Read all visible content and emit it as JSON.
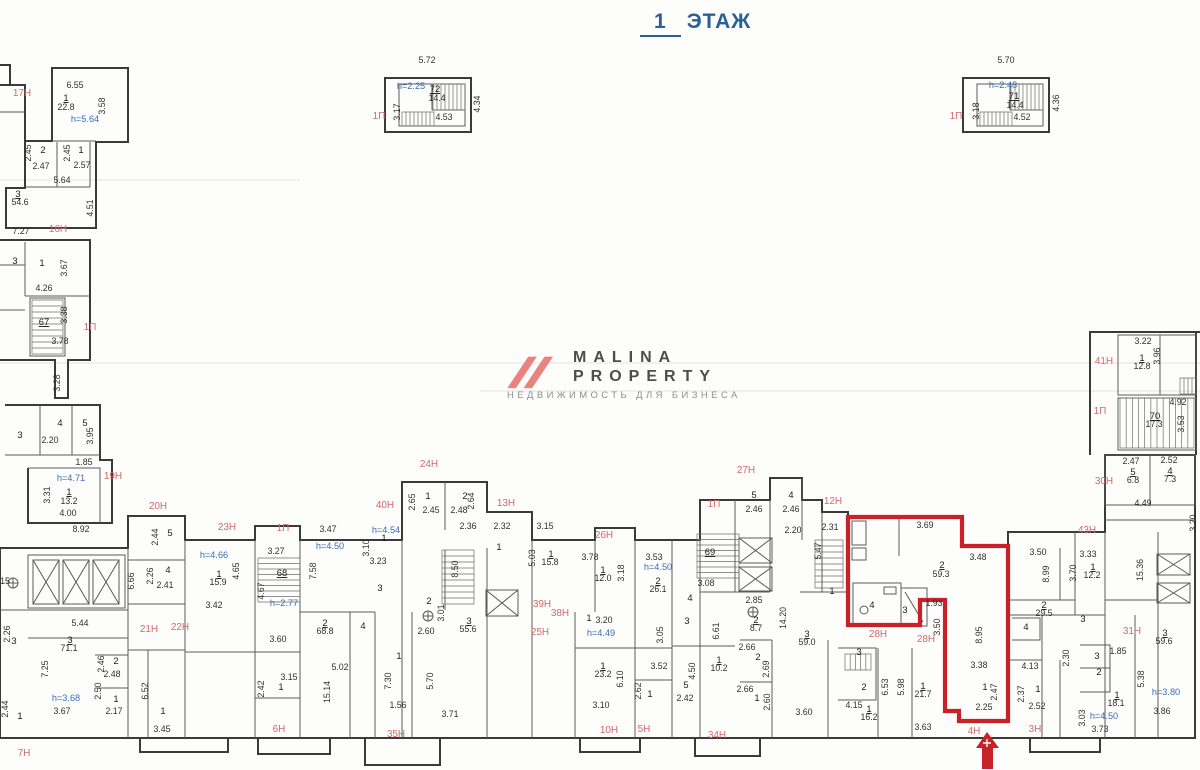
{
  "title": {
    "floor_number": "1",
    "floor_word": "ЭТАЖ"
  },
  "logo": {
    "line1": "MALINA",
    "line2": "PROPERTY",
    "tagline": "НЕДВИЖИМОСТЬ ДЛЯ БИЗНЕСА",
    "accent": "#e8837d",
    "text_color": "#4d4d4d"
  },
  "colors": {
    "title_blue": "#2a5f97",
    "dimension": "#2f2f2f",
    "unit_label_red": "#d4686d",
    "height_blue": "#3a6db4",
    "highlight_red": "#c82127",
    "wall": "#3a3a3a"
  },
  "highlight_unit": {
    "label": "4Н",
    "room_number": "2",
    "area_sqm": "59.3"
  },
  "labels": [
    [
      "5.72",
      427,
      63,
      "d",
      0
    ],
    [
      "h=2.25",
      411,
      89,
      "b",
      0
    ],
    [
      "72",
      435,
      92,
      "u",
      0
    ],
    [
      "14.4",
      437,
      101,
      "d",
      0
    ],
    [
      "3.17",
      400,
      112,
      "d",
      1
    ],
    [
      "4.34",
      480,
      104,
      "d",
      1
    ],
    [
      "4.53",
      444,
      120,
      "d",
      0
    ],
    [
      "1П",
      379,
      119,
      "r",
      0
    ],
    [
      "5.70",
      1006,
      63,
      "d",
      0
    ],
    [
      "h=2.48",
      1003,
      88,
      "b",
      0
    ],
    [
      "71",
      1014,
      99,
      "u",
      0
    ],
    [
      "14.4",
      1015,
      108,
      "d",
      0
    ],
    [
      "3.18",
      979,
      111,
      "d",
      1
    ],
    [
      "4.36",
      1059,
      103,
      "d",
      1
    ],
    [
      "4.52",
      1022,
      120,
      "d",
      0
    ],
    [
      "1П",
      956,
      119,
      "r",
      0
    ],
    [
      "17Н",
      22,
      96,
      "r",
      0
    ],
    [
      "6.55",
      75,
      88,
      "d",
      0
    ],
    [
      "1",
      66,
      101,
      "u",
      0
    ],
    [
      "22.8",
      66,
      110,
      "d",
      0
    ],
    [
      "3.58",
      105,
      106,
      "d",
      1
    ],
    [
      "h=5.64",
      85,
      122,
      "b",
      0
    ],
    [
      "2.45",
      31,
      153,
      "d",
      1
    ],
    [
      "2",
      43,
      153,
      "n",
      0
    ],
    [
      "2.47",
      41,
      169,
      "d",
      0
    ],
    [
      "2.45",
      70,
      153,
      "d",
      1
    ],
    [
      "1",
      81,
      153,
      "n",
      0
    ],
    [
      "2.57",
      82,
      168,
      "d",
      0
    ],
    [
      "5.64",
      62,
      183,
      "d",
      0
    ],
    [
      "3",
      18,
      197,
      "u",
      0
    ],
    [
      "54.6",
      20,
      205,
      "d",
      0
    ],
    [
      "4.51",
      93,
      208,
      "d",
      1
    ],
    [
      "7.27",
      21,
      234,
      "d",
      0
    ],
    [
      "16Н",
      58,
      232,
      "r",
      0
    ],
    [
      "3",
      15,
      264,
      "n",
      0
    ],
    [
      "1",
      42,
      266,
      "n",
      0
    ],
    [
      "3.67",
      67,
      268,
      "d",
      1
    ],
    [
      "4.26",
      44,
      291,
      "d",
      0
    ],
    [
      "67",
      44,
      325,
      "u",
      0
    ],
    [
      "3.38",
      67,
      315,
      "d",
      1
    ],
    [
      "1П",
      90,
      330,
      "r",
      0
    ],
    [
      "3.78",
      60,
      344,
      "d",
      0
    ],
    [
      "3.28",
      60,
      383,
      "d",
      1
    ],
    [
      "3",
      20,
      438,
      "n",
      0
    ],
    [
      "4",
      60,
      426,
      "n",
      0
    ],
    [
      "2.20",
      50,
      443,
      "d",
      0
    ],
    [
      "5",
      85,
      426,
      "n",
      0
    ],
    [
      "3.95",
      93,
      436,
      "d",
      1
    ],
    [
      "1.85",
      84,
      465,
      "d",
      0
    ],
    [
      "h=4.71",
      71,
      481,
      "b",
      0
    ],
    [
      "19Н",
      113,
      479,
      "r",
      0
    ],
    [
      "1",
      69,
      495,
      "u",
      0
    ],
    [
      "13.2",
      69,
      504,
      "d",
      0
    ],
    [
      "3.31",
      50,
      495,
      "d",
      1
    ],
    [
      "4.00",
      68,
      516,
      "d",
      0
    ],
    [
      "8.92",
      81,
      532,
      "d",
      0
    ],
    [
      "15",
      5,
      584,
      "d",
      0
    ],
    [
      "2.26",
      10,
      634,
      "d",
      1
    ],
    [
      "3",
      14,
      644,
      "n",
      0
    ],
    [
      "5.44",
      80,
      626,
      "d",
      0
    ],
    [
      "6.66",
      134,
      581,
      "d",
      1
    ],
    [
      "2.26",
      153,
      576,
      "d",
      1
    ],
    [
      "4",
      168,
      573,
      "n",
      0
    ],
    [
      "2.41",
      165,
      588,
      "d",
      0
    ],
    [
      "21Н",
      149,
      632,
      "r",
      0
    ],
    [
      "22Н",
      180,
      630,
      "r",
      0
    ],
    [
      "3",
      70,
      643,
      "u",
      0
    ],
    [
      "71.1",
      69,
      651,
      "d",
      0
    ],
    [
      "7.25",
      48,
      669,
      "d",
      1
    ],
    [
      "h=3.68",
      66,
      701,
      "b",
      0
    ],
    [
      "3.67",
      62,
      714,
      "d",
      0
    ],
    [
      "2.46",
      104,
      664,
      "d",
      1
    ],
    [
      "2",
      116,
      664,
      "n",
      0
    ],
    [
      "2.48",
      112,
      677,
      "d",
      0
    ],
    [
      "2.50",
      101,
      691,
      "d",
      1
    ],
    [
      "1",
      116,
      702,
      "n",
      0
    ],
    [
      "2.17",
      114,
      714,
      "d",
      0
    ],
    [
      "6.52",
      148,
      691,
      "d",
      1
    ],
    [
      "1",
      163,
      714,
      "n",
      0
    ],
    [
      "3.45",
      162,
      732,
      "d",
      0
    ],
    [
      "2.44",
      8,
      709,
      "d",
      1
    ],
    [
      "1",
      20,
      719,
      "n",
      0
    ],
    [
      "7Н",
      24,
      756,
      "r",
      0
    ],
    [
      "20Н",
      158,
      509,
      "r",
      0
    ],
    [
      "23Н",
      227,
      530,
      "r",
      0
    ],
    [
      "5",
      170,
      536,
      "n",
      0
    ],
    [
      "2.44",
      158,
      537,
      "d",
      1
    ],
    [
      "h=4.66",
      214,
      558,
      "b",
      0
    ],
    [
      "1",
      219,
      577,
      "u",
      0
    ],
    [
      "15.9",
      218,
      585,
      "d",
      0
    ],
    [
      "4.65",
      239,
      571,
      "d",
      1
    ],
    [
      "3.42",
      214,
      608,
      "d",
      0
    ],
    [
      "1П",
      283,
      531,
      "r",
      0
    ],
    [
      "3.27",
      276,
      554,
      "d",
      0
    ],
    [
      "68",
      282,
      576,
      "u",
      0
    ],
    [
      "4.67",
      264,
      591,
      "d",
      1
    ],
    [
      "h=2.77",
      284,
      606,
      "b",
      0
    ],
    [
      "3.60",
      278,
      642,
      "d",
      0
    ],
    [
      "40Н",
      385,
      508,
      "r",
      0
    ],
    [
      "3.47",
      328,
      532,
      "d",
      0
    ],
    [
      "h=4.50",
      330,
      549,
      "b",
      0
    ],
    [
      "7.58",
      316,
      571,
      "d",
      1
    ],
    [
      "h=4.54",
      386,
      533,
      "b",
      0
    ],
    [
      "3.10",
      369,
      548,
      "d",
      1
    ],
    [
      "1",
      384,
      541,
      "n",
      0
    ],
    [
      "3.23",
      378,
      564,
      "d",
      0
    ],
    [
      "3",
      380,
      591,
      "n",
      0
    ],
    [
      "2",
      325,
      626,
      "u",
      0
    ],
    [
      "68.8",
      325,
      634,
      "d",
      0
    ],
    [
      "4",
      363,
      629,
      "n",
      0
    ],
    [
      "5.02",
      340,
      670,
      "d",
      0
    ],
    [
      "15.14",
      330,
      692,
      "d",
      1
    ],
    [
      "3.15",
      289,
      680,
      "d",
      0
    ],
    [
      "2.42",
      264,
      689,
      "d",
      1
    ],
    [
      "1",
      281,
      690,
      "n",
      0
    ],
    [
      "6Н",
      279,
      732,
      "r",
      0
    ],
    [
      "35Н",
      396,
      737,
      "r",
      0
    ],
    [
      "1",
      399,
      659,
      "n",
      0
    ],
    [
      "7.30",
      391,
      681,
      "d",
      1
    ],
    [
      "1.56",
      398,
      708,
      "d",
      0
    ],
    [
      "24Н",
      429,
      467,
      "r",
      0
    ],
    [
      "1",
      428,
      499,
      "n",
      0
    ],
    [
      "2.65",
      415,
      502,
      "d",
      1
    ],
    [
      "2.45",
      431,
      513,
      "d",
      0
    ],
    [
      "2",
      465,
      499,
      "n",
      0
    ],
    [
      "2.64",
      474,
      501,
      "d",
      1
    ],
    [
      "2.48",
      459,
      513,
      "d",
      0
    ],
    [
      "2.36",
      468,
      529,
      "d",
      0
    ],
    [
      "13Н",
      506,
      506,
      "r",
      0
    ],
    [
      "2.32",
      502,
      529,
      "d",
      0
    ],
    [
      "3.15",
      545,
      529,
      "d",
      0
    ],
    [
      "1",
      499,
      550,
      "n",
      0
    ],
    [
      "8.50",
      458,
      569,
      "d",
      1
    ],
    [
      "5.03",
      535,
      558,
      "d",
      1
    ],
    [
      "1",
      551,
      557,
      "u",
      0
    ],
    [
      "15.8",
      550,
      565,
      "d",
      0
    ],
    [
      "2",
      429,
      604,
      "n",
      0
    ],
    [
      "3.01",
      444,
      613,
      "d",
      1
    ],
    [
      "2.60",
      426,
      634,
      "d",
      0
    ],
    [
      "3",
      469,
      624,
      "u",
      0
    ],
    [
      "55.6",
      468,
      632,
      "d",
      0
    ],
    [
      "5.70",
      433,
      681,
      "d",
      1
    ],
    [
      "3.71",
      450,
      717,
      "d",
      0
    ],
    [
      "39Н",
      542,
      607,
      "r",
      0
    ],
    [
      "38Н",
      560,
      616,
      "r",
      0
    ],
    [
      "1",
      589,
      621,
      "n",
      0
    ],
    [
      "3.20",
      604,
      623,
      "d",
      0
    ],
    [
      "25Н",
      540,
      635,
      "r",
      0
    ],
    [
      "h=4.49",
      601,
      636,
      "b",
      0
    ],
    [
      "26Н",
      604,
      538,
      "r",
      0
    ],
    [
      "3.78",
      590,
      560,
      "d",
      0
    ],
    [
      "1",
      603,
      573,
      "u",
      0
    ],
    [
      "12.0",
      603,
      581,
      "d",
      0
    ],
    [
      "3.18",
      624,
      573,
      "d",
      1
    ],
    [
      "3.53",
      654,
      560,
      "d",
      0
    ],
    [
      "h=4.50",
      658,
      570,
      "b",
      0
    ],
    [
      "2",
      658,
      584,
      "u",
      0
    ],
    [
      "26.1",
      658,
      592,
      "d",
      0
    ],
    [
      "1П",
      714,
      507,
      "r",
      0
    ],
    [
      "69",
      710,
      555,
      "u",
      0
    ],
    [
      "3.08",
      706,
      586,
      "d",
      0
    ],
    [
      "4",
      690,
      601,
      "n",
      0
    ],
    [
      "3",
      687,
      624,
      "n",
      0
    ],
    [
      "3.05",
      663,
      635,
      "d",
      1
    ],
    [
      "6.61",
      719,
      631,
      "d",
      1
    ],
    [
      "2.85",
      754,
      603,
      "d",
      0
    ],
    [
      "2",
      756,
      623,
      "u",
      0
    ],
    [
      "8.7",
      756,
      631,
      "d",
      0
    ],
    [
      "14.20",
      786,
      618,
      "d",
      1
    ],
    [
      "3",
      807,
      637,
      "u",
      0
    ],
    [
      "59.0",
      807,
      645,
      "d",
      0
    ],
    [
      "1",
      832,
      594,
      "n",
      0
    ],
    [
      "1",
      719,
      663,
      "u",
      0
    ],
    [
      "10.2",
      719,
      671,
      "d",
      0
    ],
    [
      "4.50",
      695,
      671,
      "d",
      1
    ],
    [
      "3.52",
      659,
      669,
      "d",
      0
    ],
    [
      "5",
      686,
      688,
      "n",
      0
    ],
    [
      "2.42",
      685,
      701,
      "d",
      0
    ],
    [
      "1",
      603,
      669,
      "u",
      0
    ],
    [
      "23.2",
      603,
      677,
      "d",
      0
    ],
    [
      "6.10",
      623,
      679,
      "d",
      1
    ],
    [
      "3.10",
      601,
      708,
      "d",
      0
    ],
    [
      "2.62",
      641,
      691,
      "d",
      1
    ],
    [
      "1",
      650,
      697,
      "n",
      0
    ],
    [
      "2.66",
      747,
      650,
      "d",
      0
    ],
    [
      "2",
      758,
      660,
      "n",
      0
    ],
    [
      "2.69",
      769,
      669,
      "d",
      1
    ],
    [
      "2.66",
      745,
      692,
      "d",
      0
    ],
    [
      "1",
      757,
      701,
      "n",
      0
    ],
    [
      "2.60",
      770,
      702,
      "d",
      1
    ],
    [
      "3.60",
      804,
      715,
      "d",
      0
    ],
    [
      "10Н",
      609,
      733,
      "r",
      0
    ],
    [
      "5Н",
      644,
      732,
      "r",
      0
    ],
    [
      "34Н",
      717,
      738,
      "r",
      0
    ],
    [
      "27Н",
      746,
      473,
      "r",
      0
    ],
    [
      "5",
      754,
      498,
      "n",
      0
    ],
    [
      "2.46",
      754,
      512,
      "d",
      0
    ],
    [
      "4",
      791,
      498,
      "n",
      0
    ],
    [
      "2.46",
      791,
      512,
      "d",
      0
    ],
    [
      "2.20",
      793,
      533,
      "d",
      0
    ],
    [
      "12Н",
      833,
      504,
      "r",
      0
    ],
    [
      "2.31",
      830,
      530,
      "d",
      0
    ],
    [
      "5.47",
      821,
      551,
      "d",
      1
    ],
    [
      "28Н",
      878,
      637,
      "r",
      0
    ],
    [
      "28Н",
      926,
      642,
      "r",
      0
    ],
    [
      "3",
      859,
      655,
      "n",
      0
    ],
    [
      "2",
      864,
      690,
      "n",
      0
    ],
    [
      "6.53",
      888,
      687,
      "d",
      1
    ],
    [
      "5.98",
      904,
      687,
      "d",
      1
    ],
    [
      "1",
      923,
      689,
      "u",
      0
    ],
    [
      "21.7",
      923,
      697,
      "d",
      0
    ],
    [
      "4.15",
      854,
      708,
      "d",
      0
    ],
    [
      "1",
      869,
      712,
      "u",
      0
    ],
    [
      "16.2",
      869,
      720,
      "d",
      0
    ],
    [
      "3.63",
      923,
      730,
      "d",
      0
    ],
    [
      "3.69",
      925,
      528,
      "d",
      0
    ],
    [
      "3.48",
      978,
      560,
      "d",
      0
    ],
    [
      "2",
      942,
      568,
      "u",
      0
    ],
    [
      "59.3",
      941,
      577,
      "d",
      0
    ],
    [
      "4",
      872,
      608,
      "n",
      0
    ],
    [
      "3",
      905,
      613,
      "n",
      0
    ],
    [
      "1.93",
      934,
      606,
      "d",
      0
    ],
    [
      "8.95",
      982,
      635,
      "d",
      1
    ],
    [
      "3.50",
      940,
      627,
      "d",
      1
    ],
    [
      "3.38",
      979,
      668,
      "d",
      0
    ],
    [
      "1",
      985,
      690,
      "n",
      0
    ],
    [
      "2.47",
      997,
      692,
      "d",
      1
    ],
    [
      "2.25",
      984,
      710,
      "d",
      0
    ],
    [
      "4Н",
      974,
      734,
      "r",
      0
    ],
    [
      "4.13",
      1030,
      669,
      "d",
      0
    ],
    [
      "2.37",
      1024,
      694,
      "d",
      1
    ],
    [
      "1",
      1038,
      692,
      "n",
      0
    ],
    [
      "2.52",
      1037,
      709,
      "d",
      0
    ],
    [
      "3Н",
      1035,
      732,
      "r",
      0
    ],
    [
      "2",
      1044,
      608,
      "u",
      0
    ],
    [
      "29.5",
      1044,
      616,
      "d",
      0
    ],
    [
      "4",
      1026,
      630,
      "n",
      0
    ],
    [
      "3",
      1083,
      622,
      "n",
      0
    ],
    [
      "2.30",
      1069,
      658,
      "d",
      1
    ],
    [
      "3",
      1097,
      659,
      "n",
      0
    ],
    [
      "2",
      1099,
      675,
      "n",
      0
    ],
    [
      "1.85",
      1118,
      654,
      "d",
      0
    ],
    [
      "31Н",
      1132,
      634,
      "r",
      0
    ],
    [
      "3",
      1165,
      636,
      "u",
      0
    ],
    [
      "59.6",
      1164,
      644,
      "d",
      0
    ],
    [
      "5.38",
      1144,
      679,
      "d",
      1
    ],
    [
      "1",
      1117,
      698,
      "u",
      0
    ],
    [
      "18.1",
      1116,
      706,
      "d",
      0
    ],
    [
      "h=4.50",
      1104,
      719,
      "b",
      0
    ],
    [
      "h=3.80",
      1166,
      695,
      "b",
      0
    ],
    [
      "3.86",
      1162,
      714,
      "d",
      0
    ],
    [
      "3.03",
      1085,
      718,
      "d",
      1
    ],
    [
      "3.73",
      1100,
      732,
      "d",
      0
    ],
    [
      "43Н",
      1087,
      533,
      "r",
      0
    ],
    [
      "3.50",
      1038,
      555,
      "d",
      0
    ],
    [
      "8.99",
      1049,
      574,
      "d",
      1
    ],
    [
      "3.33",
      1088,
      557,
      "d",
      0
    ],
    [
      "3.70",
      1076,
      573,
      "d",
      1
    ],
    [
      "1",
      1093,
      570,
      "u",
      0
    ],
    [
      "12.2",
      1092,
      578,
      "d",
      0
    ],
    [
      "15.36",
      1143,
      570,
      "d",
      1
    ],
    [
      "3.20",
      1196,
      523,
      "d",
      1
    ],
    [
      "4.49",
      1143,
      506,
      "d",
      0
    ],
    [
      "30Н",
      1104,
      484,
      "r",
      0
    ],
    [
      "2.47",
      1131,
      464,
      "d",
      0
    ],
    [
      "5",
      1133,
      475,
      "u",
      0
    ],
    [
      "6.8",
      1133,
      483,
      "d",
      0
    ],
    [
      "2.52",
      1169,
      463,
      "d",
      0
    ],
    [
      "4",
      1170,
      474,
      "u",
      0
    ],
    [
      "7.3",
      1170,
      482,
      "d",
      0
    ],
    [
      "1П",
      1100,
      414,
      "r",
      0
    ],
    [
      "4.92",
      1178,
      405,
      "d",
      0
    ],
    [
      "70",
      1155,
      419,
      "u",
      0
    ],
    [
      "17.3",
      1154,
      427,
      "d",
      0
    ],
    [
      "3.53",
      1184,
      424,
      "d",
      1
    ],
    [
      "41Н",
      1104,
      364,
      "r",
      0
    ],
    [
      "3.22",
      1143,
      344,
      "d",
      0
    ],
    [
      "1",
      1142,
      361,
      "u",
      0
    ],
    [
      "12.8",
      1142,
      369,
      "d",
      0
    ],
    [
      "3.96",
      1160,
      356,
      "d",
      1
    ]
  ]
}
